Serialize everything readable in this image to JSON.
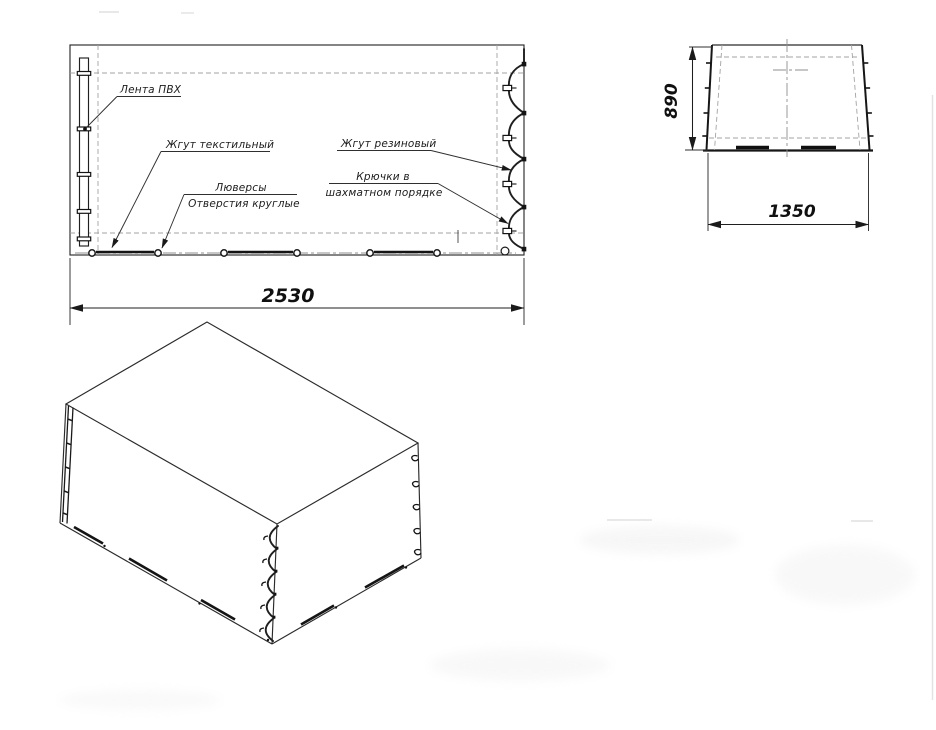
{
  "drawing": {
    "callouts": {
      "pvc_tape": "Лента ПВХ",
      "textile_cord": "Жгут текстильный",
      "grommets": "Люверсы",
      "round_holes": "Отверстия круглые",
      "rubber_cord": "Жгут резиновый",
      "hooks_row1": "Крючки в",
      "hooks_row2": "шахматном порядке"
    },
    "dimensions": {
      "length": "2530",
      "height": "890",
      "width": "1350"
    },
    "colors": {
      "line": "#1f1f1f",
      "construction": "#a3a3a3",
      "background": "#ffffff"
    }
  }
}
